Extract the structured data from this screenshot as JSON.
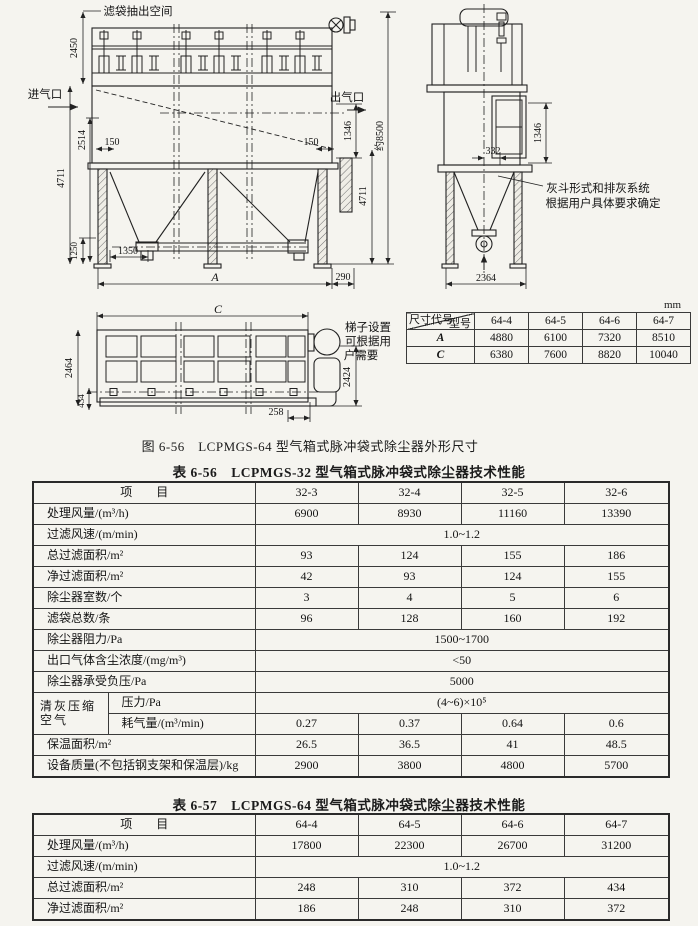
{
  "figure": {
    "caption": "图 6-56　LCPMGS-64 型气箱式脉冲袋式除尘器外形尺寸",
    "unit": "mm",
    "front": {
      "bag_space": "滤袋抽出空间",
      "inlet": "进气口",
      "outlet": "出气口",
      "d2450": "2450",
      "d2514": "2514",
      "d150_left": "150",
      "d150_right": "150",
      "d4711_left": "4711",
      "d1250": "1250",
      "d1350": "1350",
      "dim_a": "A",
      "d290": "290",
      "d1346": "1346",
      "d8500": "约8500",
      "d4711_right": "4711"
    },
    "side": {
      "d332": "332",
      "d1346": "1346",
      "d2364": "2364",
      "hopper_note_line1": "灰斗形式和排灰系统",
      "hopper_note_line2": "根据用户具体要求确定"
    },
    "plan": {
      "dim_c": "C",
      "d2464": "2464",
      "d434": "434",
      "d2424": "2424",
      "d258": "258",
      "ladder_note_line1": "梯子设置",
      "ladder_note_line2": "可根据用",
      "ladder_note_line3": "户需要"
    },
    "size_table": {
      "rows": [
        {
          "cells": [
            {
              "diag": true,
              "top": "型号",
              "bottom": "尺寸代号"
            },
            {
              "t": "64-4",
              "th": true
            },
            {
              "t": "64-5",
              "th": true
            },
            {
              "t": "64-6",
              "th": true
            },
            {
              "t": "64-7",
              "th": true
            }
          ]
        },
        {
          "cells": [
            {
              "t": "A",
              "cls": "ital"
            },
            {
              "t": "4880"
            },
            {
              "t": "6100"
            },
            {
              "t": "7320"
            },
            {
              "t": "8510"
            }
          ]
        },
        {
          "cells": [
            {
              "t": "C",
              "cls": "ital"
            },
            {
              "t": "6380"
            },
            {
              "t": "7600"
            },
            {
              "t": "8820"
            },
            {
              "t": "10040"
            }
          ]
        }
      ]
    }
  },
  "table56": {
    "title": "表 6-56　LCPMGS-32 型气箱式脉冲袋式除尘器技术性能",
    "rows": [
      {
        "cells": [
          {
            "t": "项　　目",
            "cs": 2,
            "th": true
          },
          {
            "t": "32-3",
            "th": true
          },
          {
            "t": "32-4",
            "th": true
          },
          {
            "t": "32-5",
            "th": true
          },
          {
            "t": "32-6",
            "th": true
          }
        ]
      },
      {
        "cells": [
          {
            "t": "处理风量/(m³/h)",
            "cs": 2,
            "left": true
          },
          {
            "t": "6900"
          },
          {
            "t": "8930"
          },
          {
            "t": "11160"
          },
          {
            "t": "13390"
          }
        ]
      },
      {
        "cells": [
          {
            "t": "过滤风速/(m/min)",
            "cs": 2,
            "left": true
          },
          {
            "t": "1.0~1.2",
            "cs": 4
          }
        ]
      },
      {
        "cells": [
          {
            "t": "总过滤面积/m²",
            "cs": 2,
            "left": true
          },
          {
            "t": "93"
          },
          {
            "t": "124"
          },
          {
            "t": "155"
          },
          {
            "t": "186"
          }
        ]
      },
      {
        "cells": [
          {
            "t": "净过滤面积/m²",
            "cs": 2,
            "left": true
          },
          {
            "t": "42"
          },
          {
            "t": "93"
          },
          {
            "t": "124"
          },
          {
            "t": "155"
          }
        ]
      },
      {
        "cells": [
          {
            "t": "除尘器室数/个",
            "cs": 2,
            "left": true
          },
          {
            "t": "3"
          },
          {
            "t": "4"
          },
          {
            "t": "5"
          },
          {
            "t": "6"
          }
        ]
      },
      {
        "cells": [
          {
            "t": "滤袋总数/条",
            "cs": 2,
            "left": true
          },
          {
            "t": "96"
          },
          {
            "t": "128"
          },
          {
            "t": "160"
          },
          {
            "t": "192"
          }
        ]
      },
      {
        "cells": [
          {
            "t": "除尘器阻力/Pa",
            "cs": 2,
            "left": true
          },
          {
            "t": "1500~1700",
            "cs": 4
          }
        ]
      },
      {
        "cells": [
          {
            "t": "出口气体含尘浓度/(mg/m³)",
            "cs": 2,
            "left": true
          },
          {
            "t": "<50",
            "cs": 4
          }
        ]
      },
      {
        "cells": [
          {
            "t": "除尘器承受负压/Pa",
            "cs": 2,
            "left": true
          },
          {
            "t": "5000",
            "cs": 4
          }
        ]
      },
      {
        "cells": [
          {
            "t": "清灰压缩\n空气",
            "rs": 2,
            "left": true,
            "cls": "wrap"
          },
          {
            "t": "压力/Pa",
            "left": true
          },
          {
            "t": "(4~6)×10⁵",
            "cs": 4
          }
        ]
      },
      {
        "cells": [
          {
            "t": "耗气量/(m³/min)",
            "left": true
          },
          {
            "t": "0.27"
          },
          {
            "t": "0.37"
          },
          {
            "t": "0.64"
          },
          {
            "t": "0.6"
          }
        ]
      },
      {
        "cells": [
          {
            "t": "保温面积/m²",
            "cs": 2,
            "left": true
          },
          {
            "t": "26.5"
          },
          {
            "t": "36.5"
          },
          {
            "t": "41"
          },
          {
            "t": "48.5"
          }
        ]
      },
      {
        "cells": [
          {
            "t": "设备质量(不包括钢支架和保温层)/kg",
            "cs": 2,
            "left": true
          },
          {
            "t": "2900"
          },
          {
            "t": "3800"
          },
          {
            "t": "4800"
          },
          {
            "t": "5700"
          }
        ]
      }
    ]
  },
  "table57": {
    "title": "表 6-57　LCPMGS-64 型气箱式脉冲袋式除尘器技术性能",
    "rows": [
      {
        "cells": [
          {
            "t": "项　　目",
            "cs": 2,
            "th": true
          },
          {
            "t": "64-4",
            "th": true
          },
          {
            "t": "64-5",
            "th": true
          },
          {
            "t": "64-6",
            "th": true
          },
          {
            "t": "64-7",
            "th": true
          }
        ]
      },
      {
        "cells": [
          {
            "t": "处理风量/(m³/h)",
            "cs": 2,
            "left": true
          },
          {
            "t": "17800"
          },
          {
            "t": "22300"
          },
          {
            "t": "26700"
          },
          {
            "t": "31200"
          }
        ]
      },
      {
        "cells": [
          {
            "t": "过滤风速/(m/min)",
            "cs": 2,
            "left": true
          },
          {
            "t": "1.0~1.2",
            "cs": 4
          }
        ]
      },
      {
        "cells": [
          {
            "t": "总过滤面积/m²",
            "cs": 2,
            "left": true
          },
          {
            "t": "248"
          },
          {
            "t": "310"
          },
          {
            "t": "372"
          },
          {
            "t": "434"
          }
        ]
      },
      {
        "cells": [
          {
            "t": "净过滤面积/m²",
            "cs": 2,
            "left": true
          },
          {
            "t": "186"
          },
          {
            "t": "248"
          },
          {
            "t": "310"
          },
          {
            "t": "372"
          }
        ]
      }
    ]
  }
}
